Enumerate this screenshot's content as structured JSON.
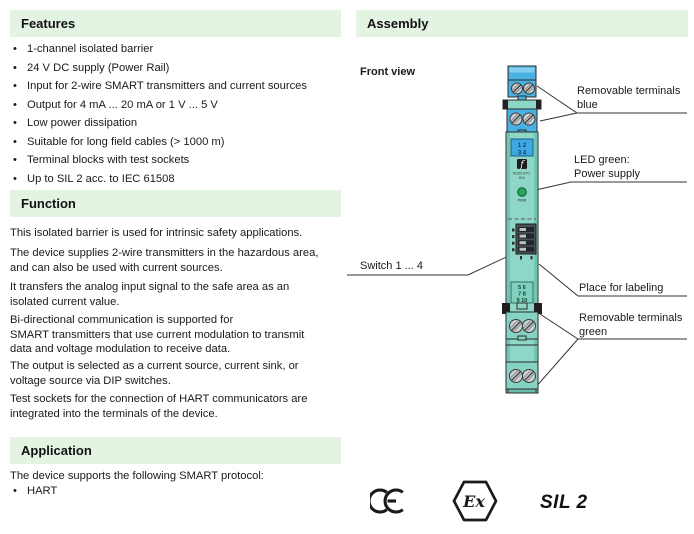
{
  "colors": {
    "section_header_bg": "#e3f4e3",
    "device_teal": "#8ed7c6",
    "device_blue": "#49b2e2",
    "led_green": "#2aa45f"
  },
  "sections": {
    "features": {
      "title": "Features",
      "items": [
        "1-channel isolated barrier",
        "24 V DC supply (Power Rail)",
        "Input for 2-wire SMART transmitters and current sources",
        "Output for 4 mA ... 20 mA or 1 V ... 5 V",
        "Low power dissipation",
        "Suitable for long field cables (> 1000 m)",
        "Terminal blocks with test sockets",
        "Up to SIL 2 acc. to IEC 61508"
      ]
    },
    "function": {
      "title": "Function",
      "paragraphs": [
        "This isolated barrier is used for intrinsic safety applications.",
        "The device supplies 2-wire transmitters in the hazardous area,\nand can also be used with current sources.",
        "It transfers the analog input signal to the safe area as an\nisolated current value.",
        "Bi-directional communication is supported for\nSMART transmitters that use current modulation to transmit\ndata and voltage modulation to receive data.",
        "The output is selected as a current source, current sink, or\nvoltage source via DIP switches.",
        "Test sockets for the connection of HART communicators are\nintegrated into the terminals of the device."
      ]
    },
    "application": {
      "title": "Application",
      "intro": "The device supports the following SMART protocol:",
      "items": [
        "HART"
      ]
    }
  },
  "assembly": {
    "title": "Assembly",
    "front_view_label": "Front view",
    "callouts": {
      "blue": {
        "lines": [
          "Removable terminals",
          "blue"
        ]
      },
      "led": {
        "lines": [
          "LED green:",
          "Power supply"
        ]
      },
      "switch": {
        "lines": [
          "Switch 1 ... 4"
        ]
      },
      "labeling": {
        "lines": [
          "Place for labeling"
        ]
      },
      "green": {
        "lines": [
          "Removable terminals",
          "green"
        ]
      }
    },
    "device": {
      "top_terminal_numbers": [
        "1  2",
        "3  4"
      ],
      "bottom_terminal_numbers": [
        "5  6",
        "7  8",
        "9  10"
      ],
      "logo_glyph": "f",
      "model_lines": [
        "KCD2-STC-",
        "Ex1"
      ],
      "led_label": "PWR"
    },
    "certifications": {
      "ce": "CE",
      "ex": "Ex",
      "sil": "SIL 2"
    }
  }
}
